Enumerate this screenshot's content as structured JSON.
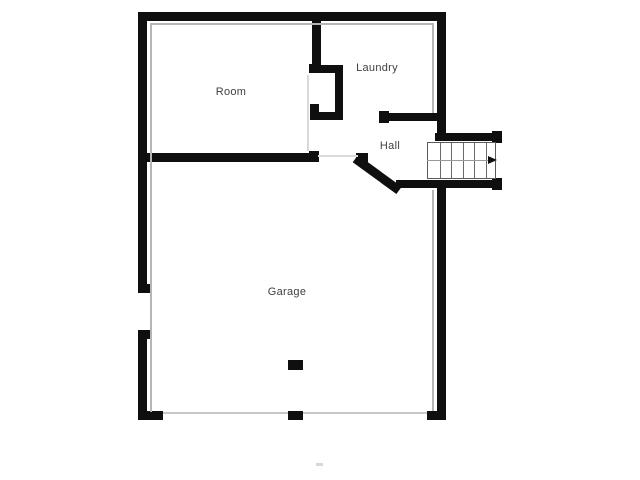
{
  "canvas": {
    "width": 640,
    "height": 480,
    "background": "#ffffff"
  },
  "palette": {
    "wall": "#0f0f0f",
    "shadow": "#b5b5b5",
    "faint": "#d9d9d9",
    "door_line": "#c8c8c8",
    "stair_border": "#5a5a5a",
    "tread": "#6a6a6a",
    "guide": "#999999",
    "arrow": "#0f0f0f",
    "label": "#3f3f3f",
    "watermark": "#d8d8d8"
  },
  "rooms": [
    {
      "label": "Room",
      "cx": 231,
      "cy": 92
    },
    {
      "label": "Laundry",
      "cx": 377,
      "cy": 68
    },
    {
      "label": "Hall",
      "cx": 390,
      "cy": 146
    },
    {
      "label": "Garage",
      "cx": 287,
      "cy": 292
    }
  ],
  "walls": [
    {
      "name": "top-wall",
      "x": 138,
      "y": 12,
      "w": 308,
      "h": 9
    },
    {
      "name": "left-wall-upper",
      "x": 138,
      "y": 12,
      "w": 9,
      "h": 281
    },
    {
      "name": "left-wall-upper-cap",
      "x": 138,
      "y": 284,
      "w": 13,
      "h": 9
    },
    {
      "name": "left-wall-lower",
      "x": 138,
      "y": 330,
      "w": 9,
      "h": 90
    },
    {
      "name": "left-wall-lower-cap",
      "x": 138,
      "y": 330,
      "w": 13,
      "h": 9
    },
    {
      "name": "garage-front-left-stub",
      "x": 138,
      "y": 411,
      "w": 25,
      "h": 9
    },
    {
      "name": "right-wall-upper",
      "x": 437,
      "y": 12,
      "w": 9,
      "h": 129
    },
    {
      "name": "right-wall-lower",
      "x": 437,
      "y": 180,
      "w": 9,
      "h": 240
    },
    {
      "name": "garage-front-right-stub",
      "x": 427,
      "y": 411,
      "w": 19,
      "h": 9
    },
    {
      "name": "room-laundry-wall",
      "x": 312,
      "y": 12,
      "w": 9,
      "h": 53
    },
    {
      "name": "room-laundry-wall-cap",
      "x": 309,
      "y": 64,
      "w": 12,
      "h": 9
    },
    {
      "name": "closet-top-wall",
      "x": 312,
      "y": 65,
      "w": 31,
      "h": 8
    },
    {
      "name": "closet-right-wall",
      "x": 335,
      "y": 65,
      "w": 8,
      "h": 55
    },
    {
      "name": "closet-bottom-wall",
      "x": 312,
      "y": 112,
      "w": 31,
      "h": 8
    },
    {
      "name": "closet-left-stub",
      "x": 310,
      "y": 104,
      "w": 9,
      "h": 16
    },
    {
      "name": "room-south-wall",
      "x": 138,
      "y": 153,
      "w": 180,
      "h": 9
    },
    {
      "name": "room-south-wall-cap",
      "x": 309,
      "y": 151,
      "w": 10,
      "h": 11
    },
    {
      "name": "laundry-south-wall",
      "x": 380,
      "y": 113,
      "w": 66,
      "h": 8
    },
    {
      "name": "laundry-south-wall-cap",
      "x": 379,
      "y": 111,
      "w": 10,
      "h": 12
    },
    {
      "name": "stair-north-wall",
      "x": 435,
      "y": 133,
      "w": 67,
      "h": 8
    },
    {
      "name": "stair-north-wall-cap",
      "x": 492,
      "y": 131,
      "w": 10,
      "h": 12
    },
    {
      "name": "hall-south-wall",
      "x": 396,
      "y": 180,
      "w": 106,
      "h": 8
    },
    {
      "name": "hall-south-wall-cap",
      "x": 492,
      "y": 178,
      "w": 10,
      "h": 12
    },
    {
      "name": "diagonal-wall-cap",
      "x": 356,
      "y": 153,
      "w": 12,
      "h": 9
    },
    {
      "name": "garage-center-post",
      "x": 288,
      "y": 360,
      "w": 15,
      "h": 10
    },
    {
      "name": "garage-door-post",
      "x": 288,
      "y": 411,
      "w": 15,
      "h": 9
    }
  ],
  "diagonal_wall": {
    "name": "hall-diagonal-wall",
    "x": 358,
    "y": 155,
    "length": 54,
    "thickness": 9,
    "angle_deg": 36
  },
  "thin_lines": [
    {
      "name": "top-wall-shadow",
      "x": 150,
      "y": 23,
      "w": 283,
      "h": 2,
      "color_key": "shadow"
    },
    {
      "name": "left-wall-shadow",
      "x": 150,
      "y": 23,
      "w": 2,
      "h": 389,
      "color_key": "shadow"
    },
    {
      "name": "right-wall-shadow-upper",
      "x": 432,
      "y": 23,
      "w": 2,
      "h": 90,
      "color_key": "shadow"
    },
    {
      "name": "right-wall-shadow-lower",
      "x": 432,
      "y": 190,
      "w": 2,
      "h": 221,
      "color_key": "shadow"
    },
    {
      "name": "room-divider-shadow",
      "x": 307,
      "y": 75,
      "w": 2,
      "h": 76,
      "color_key": "faint"
    },
    {
      "name": "hall-room-threshold",
      "x": 318,
      "y": 155,
      "w": 40,
      "h": 2,
      "color_key": "faint"
    },
    {
      "name": "garage-door-line-left",
      "x": 163,
      "y": 412,
      "w": 125,
      "h": 2,
      "color_key": "door_line"
    },
    {
      "name": "garage-door-line-right",
      "x": 303,
      "y": 412,
      "w": 124,
      "h": 2,
      "color_key": "door_line"
    }
  ],
  "stairs": {
    "x": 427,
    "y": 142,
    "w": 69,
    "h": 37,
    "treads": 6,
    "guide_y": 160,
    "direction": "right"
  },
  "watermark": {
    "x": 316,
    "y": 463,
    "w": 7,
    "h": 3
  }
}
